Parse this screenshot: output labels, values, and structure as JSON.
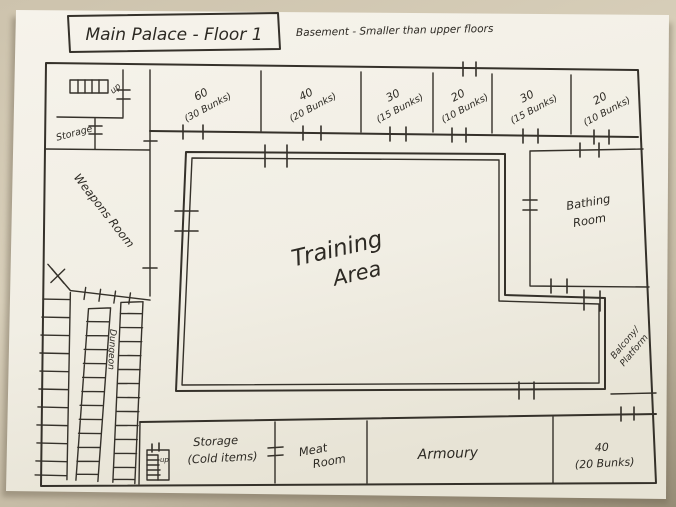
{
  "colors": {
    "ink": "#35312a",
    "paper": "#f3f0e7",
    "photo_background": "#cdc3ad"
  },
  "header": {
    "title": "Main Palace - Floor 1",
    "subtitle": "Basement - Smaller than upper floors"
  },
  "rooms": {
    "top_row": [
      {
        "size": "60",
        "capacity": "(30 Bunks)"
      },
      {
        "size": "40",
        "capacity": "(20 Bunks)"
      },
      {
        "size": "30",
        "capacity": "(15 Bunks)"
      },
      {
        "size": "20",
        "capacity": "(10 Bunks)"
      },
      {
        "size": "30",
        "capacity": "(15 Bunks)"
      },
      {
        "size": "20",
        "capacity": "(10 Bunks)"
      }
    ],
    "stairs_top": {
      "label": "up"
    },
    "storage_left": {
      "label": "Storage"
    },
    "weapons": {
      "label": "Weapons Room"
    },
    "dungeon_stairs": {
      "label": "Dungeon"
    },
    "training": {
      "line1": "Training",
      "line2": "Area"
    },
    "bathing": {
      "line1": "Bathing",
      "line2": "Room"
    },
    "balcony": {
      "line1": "Balcony/",
      "line2": "Platform"
    },
    "storage_cold": {
      "line1": "Storage",
      "line2": "(Cold items)",
      "stairs_label": "up"
    },
    "meat": {
      "line1": "Meat",
      "line2": "Room"
    },
    "armoury": {
      "label": "Armoury"
    },
    "bunks_40": {
      "line1": "40",
      "line2": "(20 Bunks)"
    }
  }
}
